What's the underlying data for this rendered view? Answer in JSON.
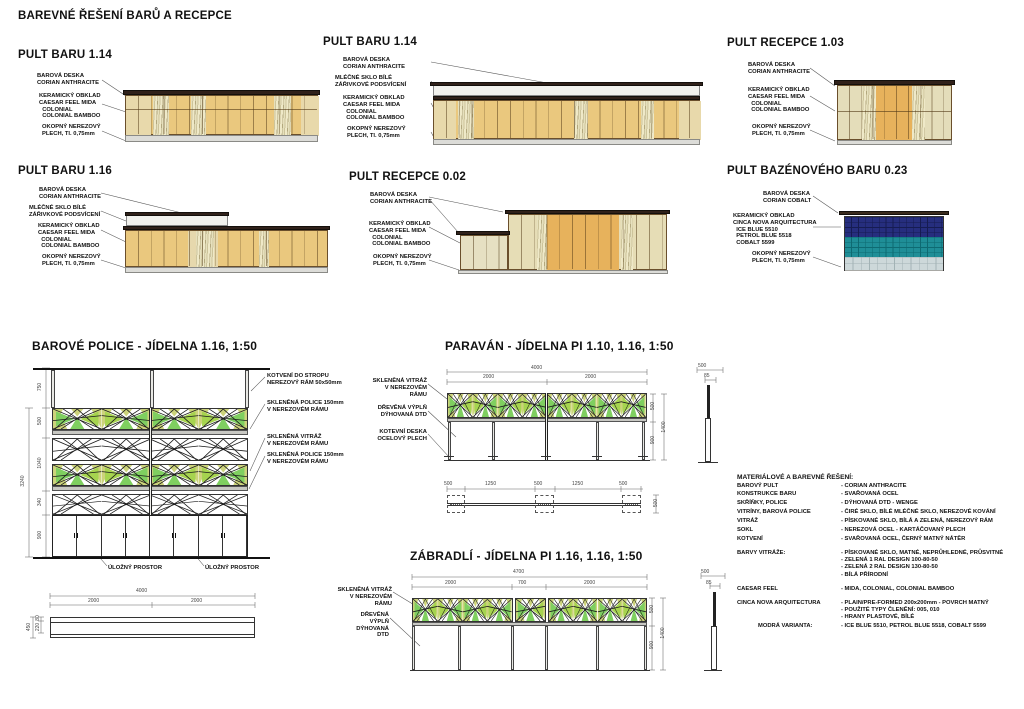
{
  "sheet_title": "BAREVNÉ ŘEŠENÍ BARŮ A RECEPCE",
  "elevations": [
    {
      "title": "PULT BARU 1.14",
      "labels": [
        "BAROVÁ DESKA\nCORIAN ANTHRACITE",
        "KERAMICKÝ OBKLAD\nCAESAR FEEL MIDA\n  COLONIAL\n  COLONIAL BAMBOO",
        "OKOPNÝ NEREZOVÝ\nPLECH, Tl. 0,75mm"
      ]
    },
    {
      "title": "PULT BARU 1.14",
      "labels": [
        "BAROVÁ DESKA\nCORIAN ANTHRACITE",
        "MLÉČNÉ SKLO BÍLÉ\nZÁŘIVKOVÉ PODSVÍCENÍ",
        "KERAMICKÝ OBKLAD\nCAESAR FEEL MIDA\n  COLONIAL\n  COLONIAL BAMBOO",
        "OKOPNÝ NEREZOVÝ\nPLECH, Tl. 0,75mm"
      ]
    },
    {
      "title": "PULT RECEPCE 1.03",
      "labels": [
        "BAROVÁ DESKA\nCORIAN ANTHRACITE",
        "KERAMICKÝ OBKLAD\nCAESAR FEEL MIDA\n  COLONIAL\n  COLONIAL BAMBOO",
        "OKOPNÝ NEREZOVÝ\nPLECH, Tl. 0,75mm"
      ]
    },
    {
      "title": "PULT BARU 1.16",
      "labels": [
        "BAROVÁ DESKA\nCORIAN ANTHRACITE",
        "MLÉČNÉ SKLO BÍLÉ\nZÁŘIVKOVÉ PODSVÍCENÍ",
        "KERAMICKÝ OBKLAD\nCAESAR FEEL MIDA\n  COLONIAL\n  COLONIAL BAMBOO",
        "OKOPNÝ NEREZOVÝ\nPLECH, Tl. 0,75mm"
      ]
    },
    {
      "title": "PULT RECEPCE 0.02",
      "labels": [
        "BAROVÁ DESKA\nCORIAN ANTHRACITE",
        "KERAMICKÝ OBKLAD\nCAESAR FEEL MIDA\n  COLONIAL\n  COLONIAL BAMBOO",
        "OKOPNÝ NEREZOVÝ\nPLECH, Tl. 0,75mm"
      ]
    },
    {
      "title": "PULT BAZÉNOVÉHO BARU 0.23",
      "labels": [
        "BAROVÁ DESKA\nCORIAN COBALT",
        "KERAMICKÝ OBKLAD\nCINCA NOVA ARQUITECTURA\n  ICE BLUE 5510\n  PETROL BLUE 5518\n  COBALT 5599",
        "OKOPNÝ NEREZOVÝ\nPLECH, Tl. 0,75mm"
      ]
    }
  ],
  "details": {
    "police": {
      "title": "BAROVÉ POLICE - JÍDELNA 1.16, 1:50",
      "labels": [
        "KOTVENÍ DO STROPU\nNEREZOVÝ RÁM 50x50mm",
        "SKLENĚNÁ POLICE 150mm\nV NEREZOVÉM RÁMU",
        "SKLENĚNÁ VITRÁŽ\nV NEREZOVÉM RÁMU",
        "SKLENĚNÁ POLICE 150mm\nV NEREZOVÉM RÁMU"
      ],
      "storage_label": "ÚLOŽNÝ PROSTOR",
      "dims_left": [
        "750",
        "500",
        "1040",
        "340",
        "900"
      ],
      "dim_total": "3240",
      "plan_top": [
        "4000",
        "2000",
        "2000"
      ],
      "plan_left": [
        "80",
        "220",
        "450"
      ]
    },
    "paravan": {
      "title": "PARAVÁN - JÍDELNA PI 1.10, 1.16, 1:50",
      "labels": [
        "SKLENĚNÁ VITRÁŽ\nV NEREZOVÉM RÁMU",
        "DŘEVĚNÁ VÝPLŇ\nDÝHOVANÁ DTD",
        "KOTEVNÍ DESKA\nOCELOVÝ PLECH"
      ],
      "dims_top": [
        "4000",
        "2000",
        "2000"
      ],
      "dims_right": [
        "500",
        "900"
      ],
      "dim_total": "1400",
      "side_dims": [
        "500",
        "85"
      ],
      "plan_dims": [
        "500",
        "1250",
        "500",
        "1250",
        "500"
      ],
      "plan_right": "500"
    },
    "zabradli": {
      "title": "ZÁBRADLÍ - JÍDELNA PI 1.16, 1.16, 1:50",
      "labels": [
        "SKLENĚNÁ VITRÁŽ\nV NEREZOVÉM RÁMU",
        "DŘEVĚNÁ VÝPLŇ\nDÝHOVANÁ DTD"
      ],
      "dims_top": [
        "4700",
        "2000",
        "700",
        "2000"
      ],
      "dims_right": [
        "500",
        "900"
      ],
      "dim_total": "1400",
      "side_dims": [
        "500",
        "85"
      ]
    }
  },
  "materials": {
    "title": "MATERIÁLOVÉ A BAREVNÉ ŘEŠENÍ:",
    "rows": [
      {
        "k": "BAROVÝ PULT",
        "v": "- CORIAN ANTHRACITE"
      },
      {
        "k": "KONSTRUKCE BARU",
        "v": "- SVAŘOVANÁ OCEL"
      },
      {
        "k": "SKŘÍŇKY, POLICE",
        "v": "- DÝHOVANÁ DTD - WENGE"
      },
      {
        "k": "VITRÍNY, BAROVÁ POLICE",
        "v": "- ČIRÉ SKLO, BÍLÉ MLÉČNÉ SKLO, NEREZOVÉ KOVÁNÍ"
      },
      {
        "k": "VITRÁŽ",
        "v": "- PÍSKOVANÉ SKLO, BÍLÁ A ZELENÁ, NEREZOVÝ RÁM"
      },
      {
        "k": "SOKL",
        "v": "- NEREZOVÁ OCEL - KARTÁČOVANÝ PLECH"
      },
      {
        "k": "KOTVENÍ",
        "v": "- SVAŘOVANÁ OCEL, ČERNÝ MATNÝ NÁTĚR"
      },
      {
        "k": "BARVY VITRÁŽE:",
        "v": "- PÍSKOVANÉ SKLO, MATNÉ, NEPRŮHLEDNÉ, PRŮSVITNÉ\n- ZELENÁ 1 RAL DESIGN 100-80-50\n- ZELENÁ 2 RAL DESIGN 130-80-50\n- BÍLÁ PŘÍRODNÍ"
      },
      {
        "k": "CAESAR FEEL",
        "v": "- MIDA, COLONIAL, COLONIAL BAMBOO"
      },
      {
        "k": "CINCA NOVA ARQUITECTURA",
        "v": "- PLAIN/PRE-FORMED 200x200mm - POVRCH MATNÝ\n- POUŽITÉ TYPY ČLENĚNÍ: 005, 010\n- HRANY PLASTOVÉ, BÍLÉ"
      },
      {
        "k": "MODRÁ VARIANTA:",
        "v": "- ICE BLUE 5510, PETROL BLUE 5518, COBALT 5599"
      }
    ]
  },
  "colors": {
    "counter_top": "#30211a",
    "tile_tan": "#eac87e",
    "tile_orange": "#e7b25c",
    "tile_pale": "#e6ddb6",
    "plinth": "#dcdcd8",
    "pool_navy": "#262e7e",
    "pool_teal": "#1f8e97",
    "pool_light": "#cdd8da",
    "vitraz_yellow": "#ccd37b",
    "vitraz_green": "#7fcf60"
  }
}
